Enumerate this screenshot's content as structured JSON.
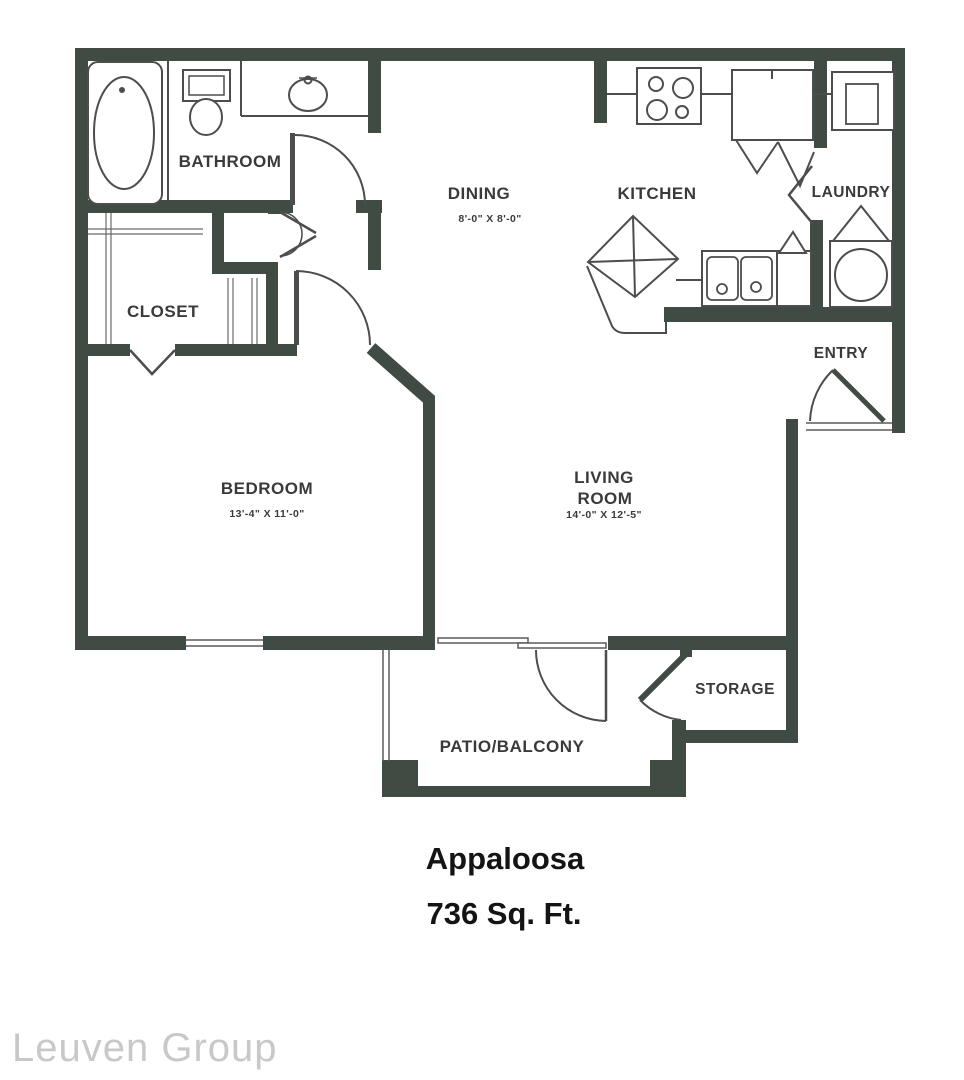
{
  "plan": {
    "title": "Appaloosa",
    "area": "736 Sq. Ft.",
    "watermark": "Leuven Group",
    "rooms": {
      "bathroom": {
        "label": "BATHROOM"
      },
      "closet": {
        "label": "CLOSET"
      },
      "bedroom": {
        "label": "BEDROOM",
        "dims": "13'-4\" X 11'-0\""
      },
      "dining": {
        "label": "DINING",
        "dims": "8'-0\" X 8'-0\""
      },
      "kitchen": {
        "label": "KITCHEN"
      },
      "laundry": {
        "label": "LAUNDRY"
      },
      "entry": {
        "label": "ENTRY"
      },
      "living": {
        "label_line1": "LIVING",
        "label_line2": "ROOM",
        "dims": "14'-0\" X 12'-5\""
      },
      "storage": {
        "label": "STORAGE"
      },
      "patio": {
        "label": "PATIO/BALCONY"
      }
    },
    "fixtures": [
      "bathtub",
      "toilet",
      "bathroom-sink",
      "stove",
      "refrigerator",
      "washer",
      "dryer",
      "kitchen-sink",
      "corner-cabinet"
    ],
    "colors": {
      "wall": "#404b43",
      "line": "#4d4d4d",
      "label": "#3a3a3a",
      "title": "#141414",
      "watermark": "#c8c8c8"
    }
  }
}
